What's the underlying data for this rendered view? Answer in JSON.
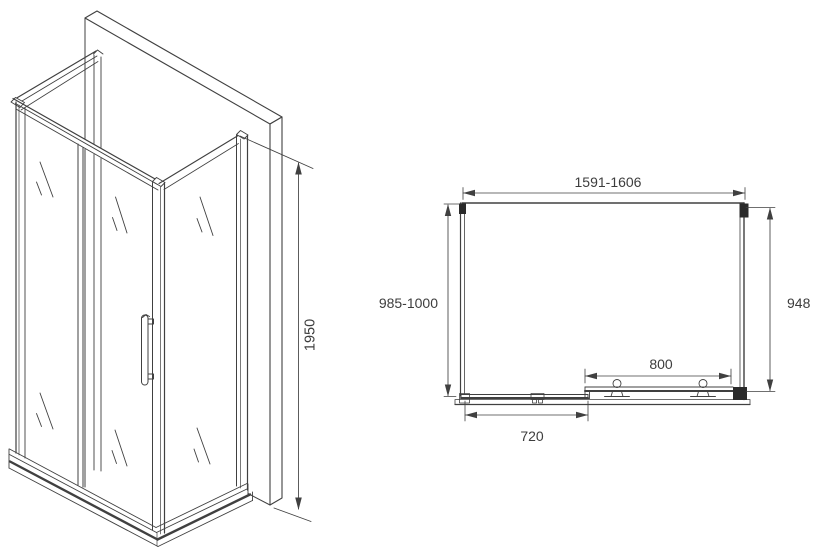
{
  "figure": {
    "title": "Shower enclosure technical drawing",
    "background": "#ffffff",
    "line_color": "#404040",
    "text_color": "#3d3d3d",
    "isometric": {
      "description": "Corner shower enclosure with sliding door, side glass panels, wall slab and base tray, isometric view",
      "height_label": "1950"
    },
    "plan": {
      "description": "Top (plan) view with overall width, side depths, sliding door and fixed panel dimensions",
      "width_label": "1591-1606",
      "left_depth_label": "985-1000",
      "right_depth_label": "948",
      "door_label": "800",
      "fixed_label": "720"
    }
  }
}
